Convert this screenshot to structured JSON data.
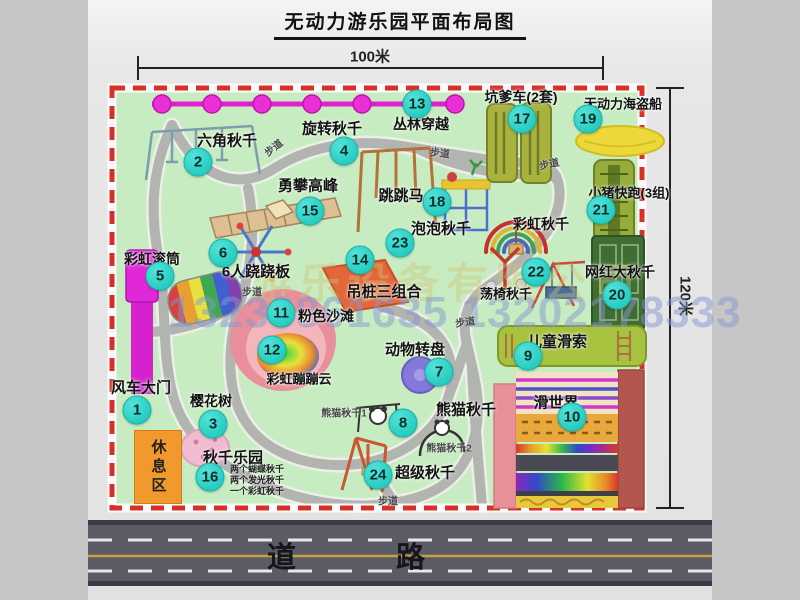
{
  "title": "无动力游乐园平面布局图",
  "dimensions": {
    "width_label": "100米",
    "height_label": "120米"
  },
  "road": {
    "label": "道 路"
  },
  "watermark": {
    "company": "游乐设备有限公司",
    "phone": "13233861635 13202178333"
  },
  "rest_area_label": "休息区",
  "path_label": "步道",
  "rainbow_swing_label": "彩虹秋千",
  "attractions": [
    {
      "num": "1",
      "label": "风车大门"
    },
    {
      "num": "2",
      "label": "六角秋千"
    },
    {
      "num": "3",
      "label": "樱花树"
    },
    {
      "num": "4",
      "label": "旋转秋千"
    },
    {
      "num": "5",
      "label": "彩虹滚筒"
    },
    {
      "num": "6",
      "label": "6人跷跷板"
    },
    {
      "num": "7",
      "label": "动物转盘"
    },
    {
      "num": "8",
      "label": "熊猫秋千"
    },
    {
      "num": "9",
      "label": "儿童滑索"
    },
    {
      "num": "10",
      "label": "滑世界"
    },
    {
      "num": "11",
      "label": "粉色沙滩"
    },
    {
      "num": "12",
      "label": "彩虹蹦蹦云"
    },
    {
      "num": "13",
      "label": "丛林穿越"
    },
    {
      "num": "14",
      "label": "吊桩三组合"
    },
    {
      "num": "15",
      "label": "勇攀高峰"
    },
    {
      "num": "16",
      "label": "秋千乐园"
    },
    {
      "num": "17",
      "label": "坑爹车(2套)"
    },
    {
      "num": "18",
      "label": "跳跳马"
    },
    {
      "num": "19",
      "label": "无动力海盗船"
    },
    {
      "num": "20",
      "label": "网红大秋千"
    },
    {
      "num": "21",
      "label": "小猪快跑(3组)"
    },
    {
      "num": "22",
      "label": "荡椅秋千"
    },
    {
      "num": "23",
      "label": "泡泡秋千"
    },
    {
      "num": "24",
      "label": "超级秋千"
    }
  ],
  "swing_park_details": [
    "两个蝴蝶秋千",
    "两个发光秋千",
    "一个彩虹秋千"
  ],
  "panda_swing_subs": [
    "熊猫秋千1",
    "熊猫秋千2"
  ],
  "colors": {
    "marker": "#27cdc2",
    "border_dashed": "#d83028",
    "park_green": "#c8ecc2",
    "road_gray": "#5b5b66",
    "gate_magenta": "#d922cc",
    "rest_orange": "#f2992e",
    "zipline_magenta": "#e11fd0"
  }
}
